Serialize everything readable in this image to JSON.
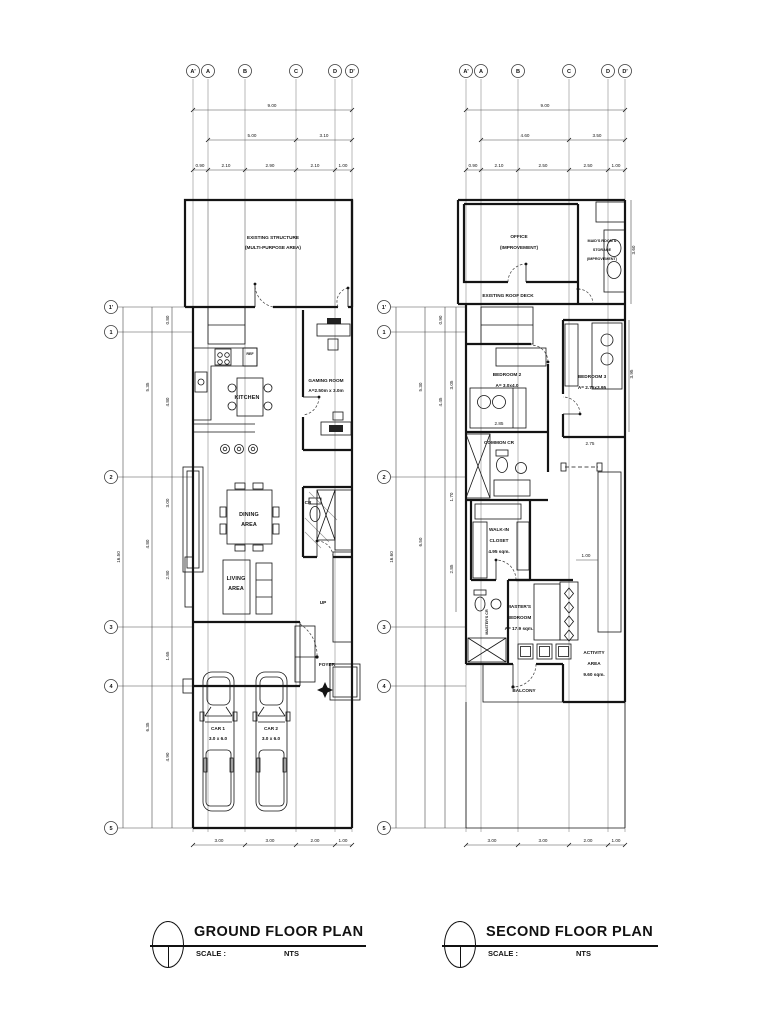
{
  "ground": {
    "title": "GROUND FLOOR PLAN",
    "scale_label": "SCALE :",
    "scale_value": "NTS",
    "cols": [
      "A'",
      "A",
      "B",
      "C",
      "D",
      "D'"
    ],
    "rows": [
      "1'",
      "1",
      "2",
      "3",
      "4",
      "5"
    ],
    "dims": {
      "total": "9.00",
      "mid": [
        "5.00",
        "3.10"
      ],
      "segs": [
        "0.90",
        "2.10",
        "2.90",
        "2.10",
        "1.00"
      ],
      "bottom": [
        "3.00",
        "3.00",
        "2.00",
        "1.00"
      ],
      "left_overall": "16.50",
      "left_mid": [
        "5.35",
        "4.80",
        "6.35"
      ],
      "left_inner": [
        "0.80",
        "4.80",
        "3.00",
        "2.80",
        "1.65",
        "4.90"
      ]
    },
    "labels": {
      "ex1": "EXISTING STRUCTURE",
      "ex2": "(MULTI-PURPOSE AREA)",
      "kitchen": "KITCHEN",
      "ref": "REF",
      "gaming1": "GAMING ROOM",
      "gaming2": "A=2.50m x 3.0m",
      "dining1": "DINING",
      "dining2": "AREA",
      "cr": "CR",
      "up": "UP",
      "living1": "LIVING",
      "living2": "AREA",
      "foyer": "FOYER",
      "car1a": "CAR 1",
      "car1b": "3.0 x 6.0",
      "car2a": "CAR 2",
      "car2b": "3.0 x 6.0"
    }
  },
  "second": {
    "title": "SECOND FLOOR PLAN",
    "scale_label": "SCALE :",
    "scale_value": "NTS",
    "cols": [
      "A'",
      "A",
      "B",
      "C",
      "D",
      "D'"
    ],
    "rows": [
      "1'",
      "1",
      "2",
      "3",
      "4",
      "5"
    ],
    "dims": {
      "total": "9.00",
      "mid": [
        "4.60",
        "3.50"
      ],
      "segs": [
        "0.90",
        "2.10",
        "2.50",
        "2.50",
        "1.00"
      ],
      "bottom": [
        "3.00",
        "3.00",
        "2.00",
        "1.00"
      ],
      "left_overall": "16.60",
      "left_mid": [
        "5.30",
        "6.50"
      ],
      "left_inner": [
        "0.90",
        "4.45"
      ],
      "left_inner2": [
        "3.05",
        "1.70",
        "2.85"
      ],
      "right": [
        "3.60",
        "3.95"
      ],
      "bed2": "2.85",
      "bed3": "2.75",
      "stair": "1.00"
    },
    "labels": {
      "office1": "OFFICE",
      "office2": "(IMPROVEMENT)",
      "maid1": "MAID'S ROOM &",
      "maid2": "STORAGE",
      "maid3": "(IMPROVEMENT)",
      "deck": "EXISTING ROOF DECK",
      "br2a": "BEDROOM 2",
      "br2b": "A= 3.0x4.0",
      "br3a": "BEDROOM 3",
      "br3b": "A= 2.75x3.95",
      "ccr": "COMMON CR",
      "wic1": "WALK-IN",
      "wic2": "CLOSET",
      "wic3": "4.95 sqm.",
      "mcr": "MASTER'S CR",
      "mb1": "MASTER'S",
      "mb2": "BEDROOM",
      "mb3": "A= 17.9 sqm.",
      "act1": "ACTIVITY",
      "act2": "AREA",
      "act3": "9.60 sqm.",
      "balcony": "BALCONY"
    }
  }
}
